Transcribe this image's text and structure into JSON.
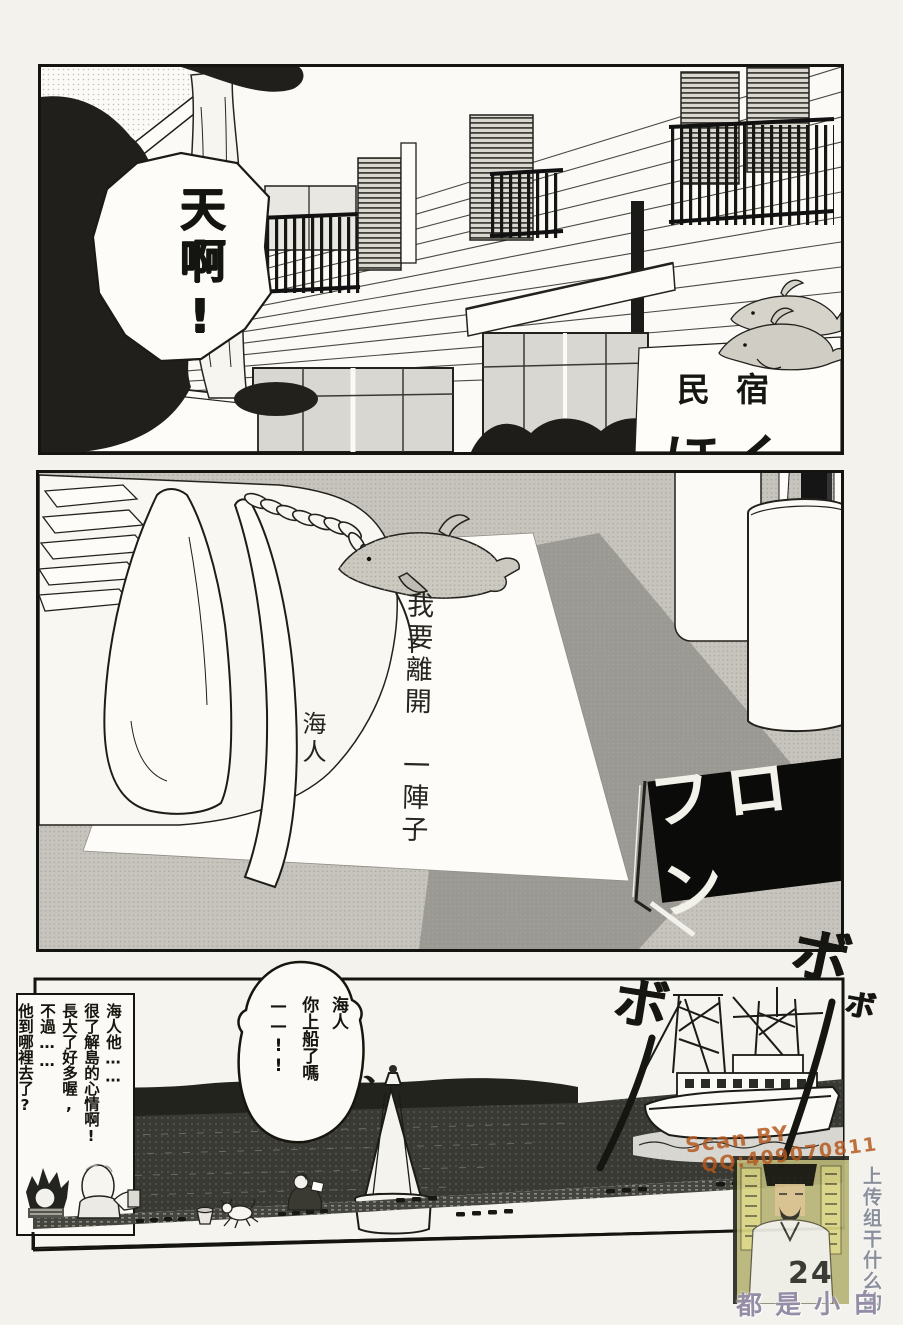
{
  "panel1": {
    "speech_bubble": "天啊!",
    "sign": {
      "line1": "民宿",
      "line2": "ほくま"
    }
  },
  "panel2": {
    "note": {
      "body": "我要離開　一陣子",
      "signature": "海人"
    },
    "front_desk_sign": "フロン"
  },
  "panel3": {
    "shout_bubble": "海人\n你上船了嗎\n——!!",
    "narration_box": "海人他……\n很了解島的心情啊!\n長大了好多喔,\n不過……\n他到哪裡去了?",
    "sfx": [
      "ボ",
      "ボ",
      "ボ"
    ]
  },
  "watermarks": {
    "scanner_line1": "Scan BY",
    "scanner_line2": "QQ:409070811",
    "side_vertical_text": "上传组干什么的",
    "bottom_text": "都是小白",
    "page_number": "24"
  },
  "colors": {
    "ink": "#141411",
    "scanner_orange": "#b4571c",
    "stamp_olive": "#b7b478",
    "margin_text_purple": "#958ca6"
  }
}
